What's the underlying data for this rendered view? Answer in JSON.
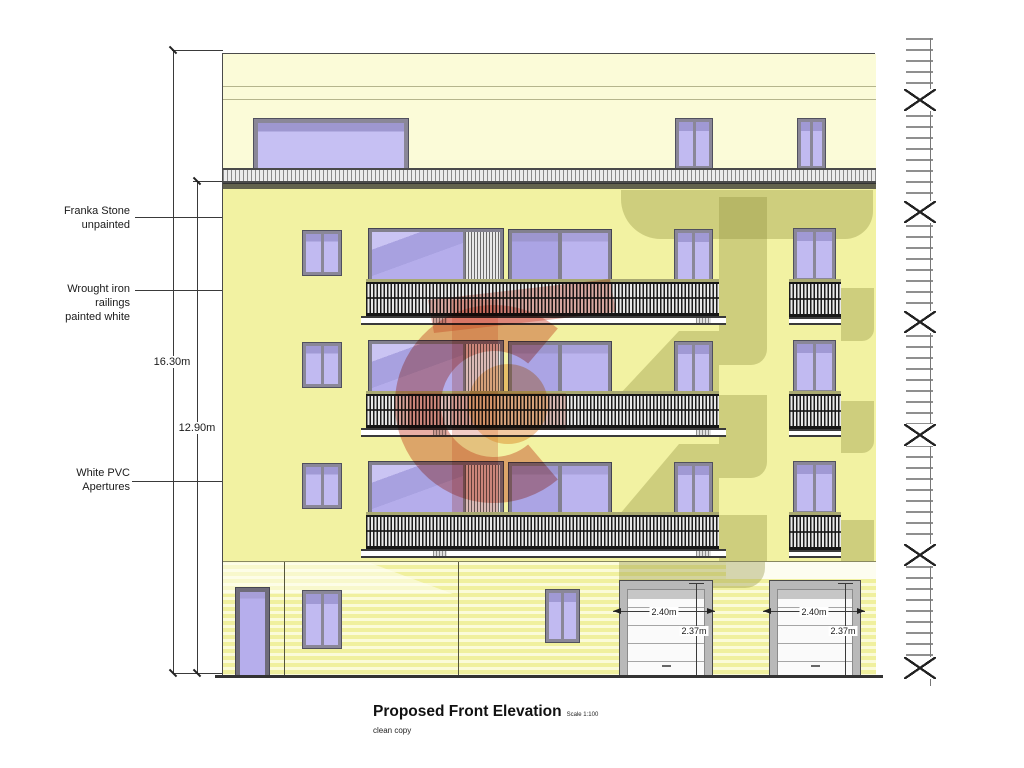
{
  "title_block": {
    "title": "Proposed Front Elevation",
    "scale": "Scale 1:100",
    "note": "clean copy"
  },
  "annotations": {
    "stone": "Franka Stone\nunpainted",
    "railings": "Wrought iron\nrailings\npainted white",
    "apertures": "White PVC\nApertures"
  },
  "dimensions": {
    "overall_height": "16.30m",
    "upper_floors_height": "12.90m",
    "garages": [
      {
        "width": "2.40m",
        "height": "2.37m"
      },
      {
        "width": "2.40m",
        "height": "2.37m"
      }
    ]
  },
  "colors": {
    "facade_yellow": "#f2f2a2",
    "penthouse_pale": "#fbfbd8",
    "ground_stripe": "#f0f09e",
    "shadow_olive": "#94924a",
    "window_glass": "#b9b1ec",
    "frame_gray": "#8a8798",
    "slab_white": "#ffffff",
    "watermark_red": "#cd4b37",
    "watermark_orange": "#e89646"
  }
}
